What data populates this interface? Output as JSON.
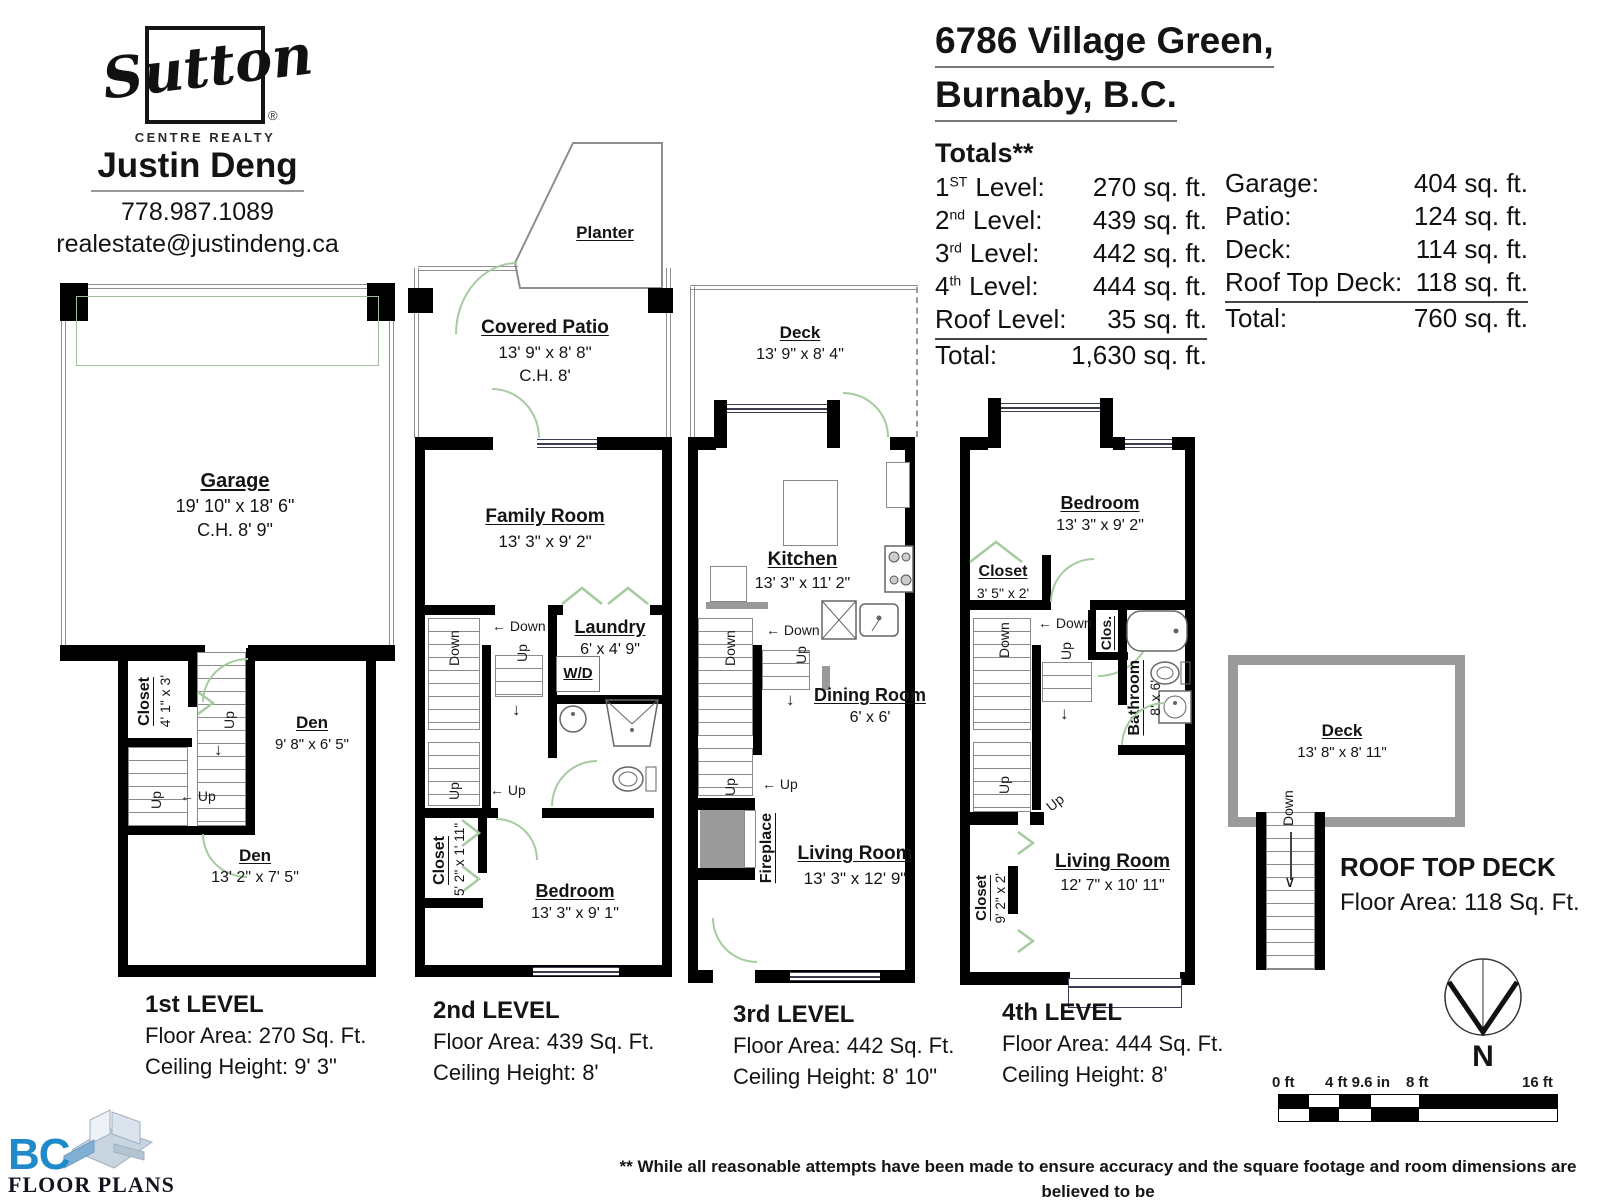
{
  "brand": {
    "logo": "Sutton",
    "logo_sub": "CENTRE REALTY",
    "reg": "®",
    "agent_name": "Justin Deng",
    "phone": "778.987.1089",
    "email": "realestate@justindeng.ca"
  },
  "address": {
    "line1": "6786 Village Green,",
    "line2": "Burnaby, B.C."
  },
  "totals": {
    "title": "Totals**",
    "left": [
      {
        "n": "1",
        "s": "ST",
        "l": "Level:",
        "v": "270 sq. ft."
      },
      {
        "n": "2",
        "s": "nd",
        "l": "Level:",
        "v": "439 sq. ft."
      },
      {
        "n": "3",
        "s": "rd",
        "l": "Level:",
        "v": "442 sq. ft."
      },
      {
        "n": "4",
        "s": "th",
        "l": "Level:",
        "v": "444 sq. ft."
      },
      {
        "n": "",
        "s": "",
        "l": "Roof Level:",
        "v": "35 sq. ft."
      },
      {
        "n": "",
        "s": "",
        "l": "Total:",
        "v": "1,630 sq. ft."
      }
    ],
    "right": [
      {
        "l": "Garage:",
        "v": "404 sq. ft."
      },
      {
        "l": "Patio:",
        "v": "124 sq. ft."
      },
      {
        "l": "Deck:",
        "v": "114 sq. ft."
      },
      {
        "l": "Roof Top Deck:",
        "v": "118 sq. ft."
      },
      {
        "l": "Total:",
        "v": "760 sq. ft."
      }
    ]
  },
  "stairs": {
    "up": "Up",
    "down": "Down"
  },
  "level1": {
    "caption": {
      "title": "1st LEVEL",
      "area": "Floor Area: 270 Sq. Ft.",
      "ceiling": "Ceiling Height: 9' 3\""
    },
    "garage": {
      "name": "Garage",
      "dims": "19' 10\" x 18' 6\"",
      "ch": "C.H. 8' 9\""
    },
    "closet": {
      "name": "Closet",
      "dims": "4' 1\" x 3'"
    },
    "den1": {
      "name": "Den",
      "dims": "9' 8\" x 6' 5\""
    },
    "den2": {
      "name": "Den",
      "dims": "13' 2\" x 7' 5\""
    }
  },
  "level2": {
    "caption": {
      "title": "2nd LEVEL",
      "area": "Floor Area: 439 Sq. Ft.",
      "ceiling": "Ceiling Height: 8'"
    },
    "planter": {
      "name": "Planter"
    },
    "patio": {
      "name": "Covered Patio",
      "dims": "13' 9\" x 8' 8\"",
      "ch": "C.H. 8'"
    },
    "family": {
      "name": "Family Room",
      "dims": "13' 3\" x 9' 2\""
    },
    "laundry": {
      "name": "Laundry",
      "dims": "6' x 4' 9\"",
      "wd": "W/D"
    },
    "closet": {
      "name": "Closet",
      "dims": "5' 2\" x 1' 11\""
    },
    "bedroom": {
      "name": "Bedroom",
      "dims": "13' 3\" x 9' 1\""
    }
  },
  "level3": {
    "caption": {
      "title": "3rd LEVEL",
      "area": "Floor Area: 442 Sq. Ft.",
      "ceiling": "Ceiling Height: 8' 10\""
    },
    "deck": {
      "name": "Deck",
      "dims": "13' 9\" x 8' 4\""
    },
    "kitchen": {
      "name": "Kitchen",
      "dims": "13' 3\" x 11' 2\""
    },
    "dining": {
      "name": "Dining Room",
      "dims": "6' x 6'"
    },
    "fireplace": {
      "name": "Fireplace"
    },
    "living": {
      "name": "Living Room",
      "dims": "13' 3\" x 12' 9\""
    }
  },
  "level4": {
    "caption": {
      "title": "4th LEVEL",
      "area": "Floor Area: 444 Sq. Ft.",
      "ceiling": "Ceiling Height: 8'"
    },
    "bedroom": {
      "name": "Bedroom",
      "dims": "13' 3\" x 9' 2\""
    },
    "closet1": {
      "name": "Closet",
      "dims": "3' 5\" x 2'"
    },
    "clos": {
      "name": "Clos."
    },
    "bathroom": {
      "name": "Bathroom",
      "dims": "8' x 6'"
    },
    "closet2": {
      "name": "Closet",
      "dims": "9' 2\" x 2'"
    },
    "living": {
      "name": "Living Room",
      "dims": "12' 7\" x 10' 11\""
    }
  },
  "roof": {
    "deck": {
      "name": "Deck",
      "dims": "13' 8\" x 8' 11\""
    },
    "caption": {
      "title": "ROOF TOP DECK",
      "area": "Floor Area: 118 Sq. Ft."
    }
  },
  "compass": {
    "label": "N"
  },
  "scalebar": {
    "t0": "0 ft",
    "t1": "4 ft 9.6 in",
    "t2": "8 ft",
    "t3": "16 ft"
  },
  "footer_logo": {
    "bc": "BC",
    "text": "FLOOR PLANS"
  },
  "disclaimer": {
    "line1": "** While all reasonable attempts have been made to ensure accuracy and the square footage and room dimensions are believed to be",
    "line2": "correct to ANSI Standards, due to the possibility of human error the information cannot be guaranteed. E&O Insured for $1,000,000"
  }
}
